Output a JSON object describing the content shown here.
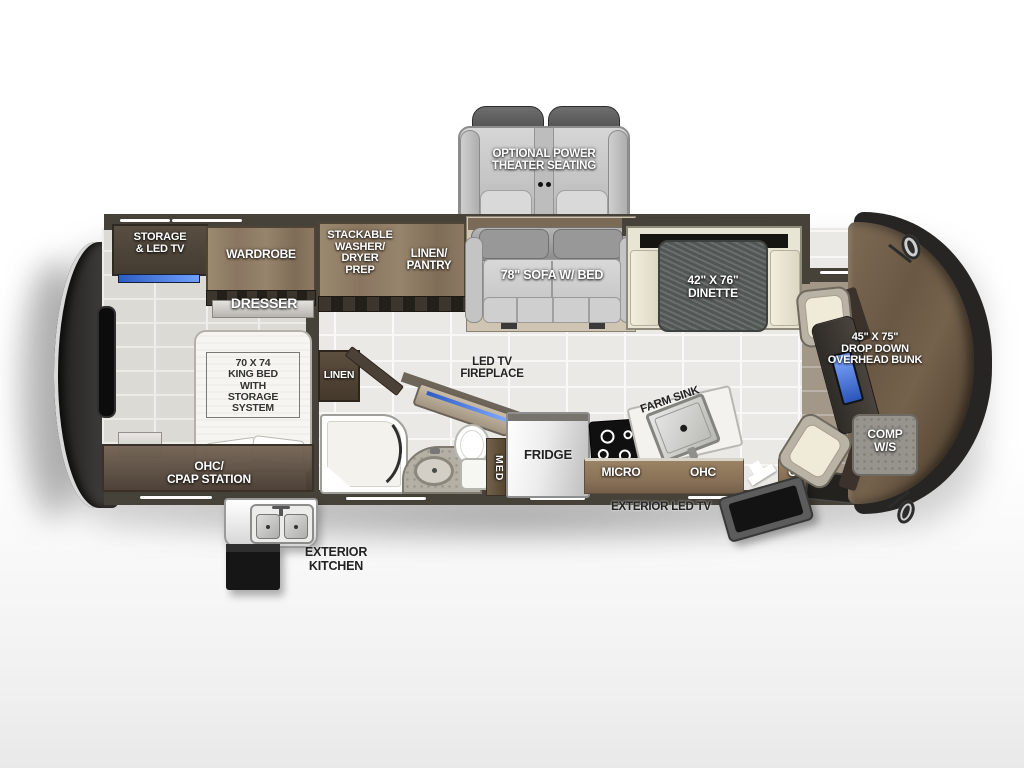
{
  "labels": {
    "theater": "OPTIONAL POWER\nTHEATER SEATING",
    "storage_tv": "STORAGE\n& LED TV",
    "wardrobe": "WARDROBE",
    "dresser": "DRESSER",
    "washer_prep": "STACKABLE\nWASHER/\nDRYER\nPREP",
    "linen_pantry": "LINEN/\nPANTRY",
    "sofa": "78\" SOFA W/ BED",
    "dinette": "42\" X 76\"\nDINETTE",
    "king_bed": "70 X 74\nKING BED\nWITH\nSTORAGE SYSTEM",
    "ohc_cpap": "OHC/\nCPAP STATION",
    "linen": "LINEN",
    "fireplace": "LED TV\nFIREPLACE",
    "med": "MED",
    "fridge": "FRIDGE",
    "farm_sink": "FARM SINK",
    "micro": "MICRO",
    "ohc_kitchen": "OHC",
    "ohc_entry": "OHC",
    "exterior_tv": "EXTERIOR LED TV",
    "exterior_kitchen": "EXTERIOR\nKITCHEN",
    "bunk": "45\" X 75\"\nDROP DOWN\nOVERHEAD BUNK",
    "comp_ws": "COMP\nW/S"
  },
  "colors": {
    "accent_blue": "#3f6fd1",
    "cabinet_wood": "#8d7963",
    "wall": "#474239",
    "front_cap": "#6b5844",
    "rear_cap": "#2a2928",
    "floor_tile": "#ebe9e5",
    "dinette_table": "#585d5c",
    "label_white": "#ffffff",
    "label_dark": "#232323"
  }
}
